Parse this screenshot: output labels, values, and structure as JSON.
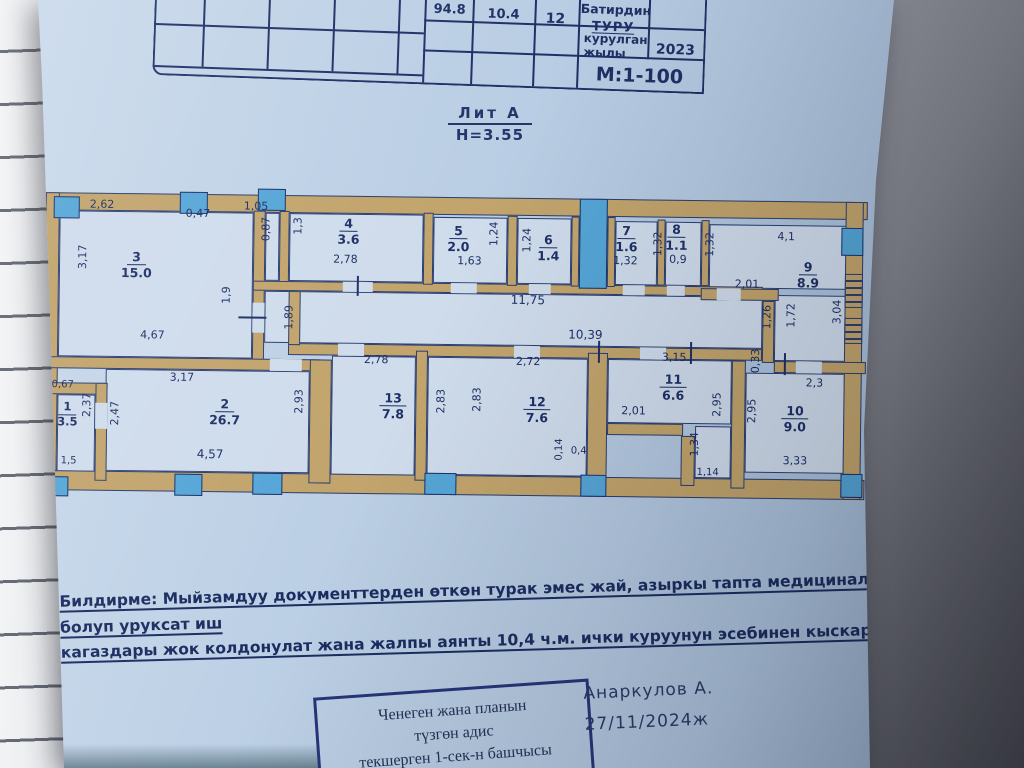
{
  "document": {
    "table": {
      "values": [
        "94.8",
        "10.4",
        "12"
      ],
      "apt_type_label_top": "Батирдин",
      "apt_type_label_bottom": "ТУРУ",
      "year_label_line1": "курулган",
      "year_label_line2": "жылы",
      "year_value": "2023",
      "scale": "М:1-100"
    },
    "plan_title": {
      "liter": "Лит А",
      "height": "H=3.55"
    },
    "plan": {
      "corridor_dims": [
        "11,75",
        "10,39"
      ],
      "rooms": [
        {
          "num": "1",
          "area": "3.5",
          "dims": [
            "0,67",
            "2,37",
            "1,5"
          ]
        },
        {
          "num": "2",
          "area": "26.7",
          "dims": [
            "3,17",
            "2,47",
            "4,57",
            "2,93"
          ]
        },
        {
          "num": "3",
          "area": "15.0",
          "dims": [
            "2,62",
            "0,47",
            "1,05",
            "3,17",
            "1,9",
            "4,67",
            "0,87",
            "1,89"
          ]
        },
        {
          "num": "4",
          "area": "3.6",
          "dims": [
            "1,3",
            "2,78"
          ]
        },
        {
          "num": "5",
          "area": "2.0",
          "dims": [
            "1,24",
            "1,63"
          ]
        },
        {
          "num": "6",
          "area": "1.4",
          "dims": [
            "1,24"
          ]
        },
        {
          "num": "7",
          "area": "1.6",
          "dims": [
            "1,32",
            "1,32"
          ]
        },
        {
          "num": "8",
          "area": "1.1",
          "dims": [
            "0,9",
            "1,32"
          ]
        },
        {
          "num": "9",
          "area": "8.9",
          "dims": [
            "4,1",
            "2,01",
            "1,26",
            "1,72",
            "3,04",
            "0,33",
            "2,3"
          ]
        },
        {
          "num": "10",
          "area": "9.0",
          "dims": [
            "2,95",
            "3,33"
          ]
        },
        {
          "num": "11",
          "area": "6.6",
          "dims": [
            "3,15",
            "2,01",
            "2,95",
            "1,34",
            "1,14"
          ]
        },
        {
          "num": "12",
          "area": "7.6",
          "dims": [
            "2,72",
            "2,83",
            "0,14",
            "0,4"
          ]
        },
        {
          "num": "13",
          "area": "7.8",
          "dims": [
            "2,78",
            "2,83"
          ]
        }
      ]
    },
    "note": {
      "line1": "Билдирме: Мыйзамдуу документтерден өткөн турак эмес жай, азыркы тапта медициналык борбор болуп уруксат иш",
      "line2": "кагаздары жок колдонулат жана жалпы аянты 10,4 ч.м. ички куруунун эсебинен кыскарган."
    },
    "stamp_box": {
      "line1": "Ченеген жана планын",
      "line2": "түзгөн адис",
      "line3": "текшерген 1-сек-н башчысы"
    },
    "signature": {
      "name": "Анаркулов А.",
      "date": "27/11/2024ж"
    },
    "colors": {
      "ink": "#1e3066",
      "wall": "#c2a46c",
      "window": "#55a6d7",
      "paper": "#b9cde4"
    }
  }
}
